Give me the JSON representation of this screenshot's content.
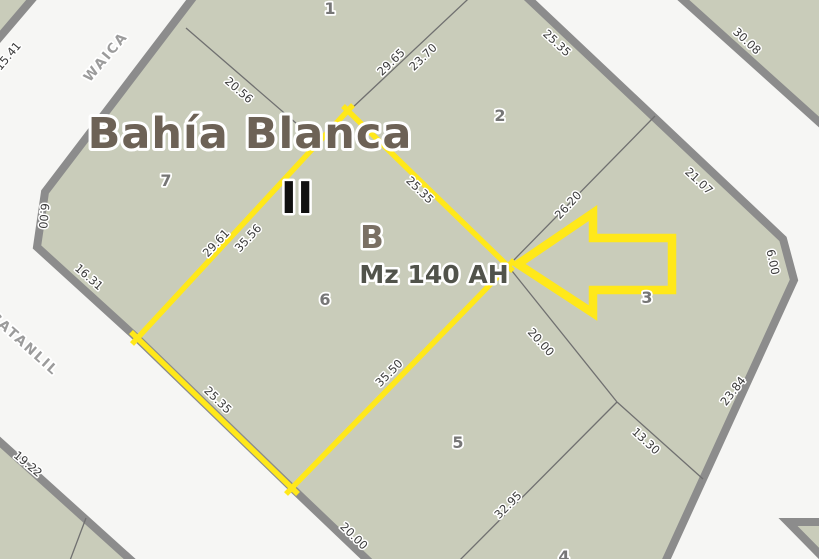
{
  "map": {
    "title": "Bahía Blanca",
    "section_label": "II",
    "zone_label": "B",
    "block_label": "Mz 140 AH",
    "streets": [
      {
        "name": "WAICA"
      },
      {
        "name": "CATANLIL"
      }
    ],
    "parcels": [
      {
        "number": "1"
      },
      {
        "number": "2"
      },
      {
        "number": "3"
      },
      {
        "number": "4"
      },
      {
        "number": "5"
      },
      {
        "number": "6"
      },
      {
        "number": "7"
      }
    ],
    "measurements": [
      {
        "value": "15.41"
      },
      {
        "value": "20.56"
      },
      {
        "value": "29.65"
      },
      {
        "value": "23.70"
      },
      {
        "value": "25.35"
      },
      {
        "value": "30.08"
      },
      {
        "value": "21.07"
      },
      {
        "value": "26.20"
      },
      {
        "value": "6.00"
      },
      {
        "value": "23.84"
      },
      {
        "value": "13.30"
      },
      {
        "value": "32.95"
      },
      {
        "value": "20.00"
      },
      {
        "value": "20.00"
      },
      {
        "value": "35.50"
      },
      {
        "value": "25.35"
      },
      {
        "value": "16.31"
      },
      {
        "value": "6.00"
      },
      {
        "value": "19.22"
      },
      {
        "value": "29.61"
      },
      {
        "value": "35.56"
      },
      {
        "value": "25.35"
      }
    ]
  },
  "colors": {
    "street_background": "#f6f6f4",
    "block_fill": "#c9ccba",
    "block_border": "#8c8c8c",
    "parcel_line": "#707070",
    "highlight_yellow": "#ffe81a",
    "title_brown": "#6d6256",
    "block_label_dark": "#51534b",
    "parcel_number_gray": "#767676",
    "measurement_dark": "#3a3a3a",
    "street_name_gray": "#9b9b9b",
    "section_black": "#101010"
  }
}
